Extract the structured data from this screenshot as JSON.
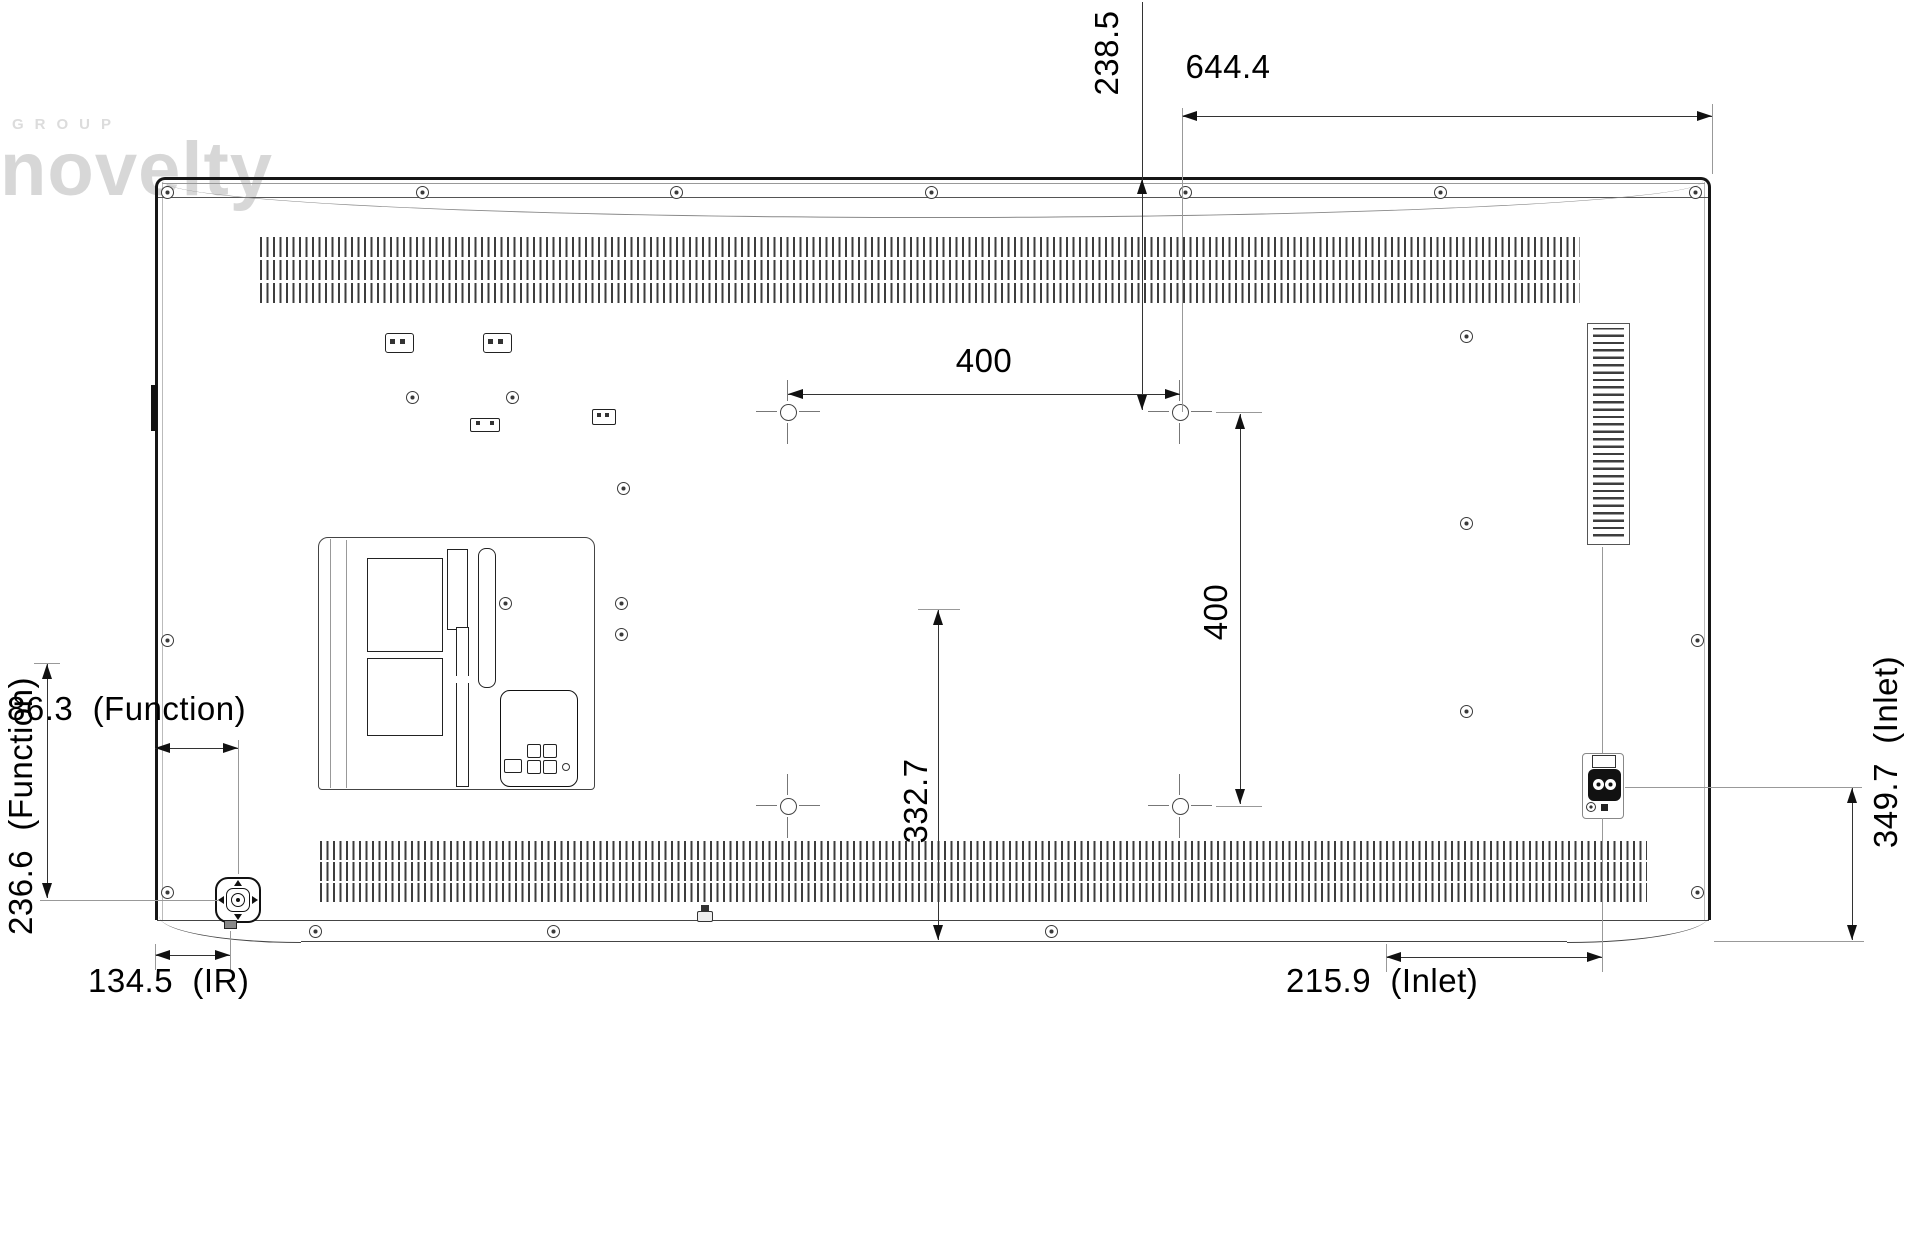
{
  "watermark": {
    "group": "GROUP",
    "name": "novelty"
  },
  "dimensions": {
    "vesa_top_offset": {
      "text": "238.5",
      "orientation": "vertical",
      "meaning": "top edge to upper VESA hole row"
    },
    "top_right_width": {
      "text": "644.4",
      "orientation": "horizontal",
      "meaning": "upper VESA hole to right edge"
    },
    "vesa_width": {
      "text": "400",
      "orientation": "horizontal",
      "meaning": "VESA hole horizontal pitch"
    },
    "vesa_height": {
      "text": "400",
      "orientation": "vertical",
      "meaning": "VESA hole vertical pitch"
    },
    "function_offset_x": {
      "text": "86.3  (Function)",
      "orientation": "horizontal",
      "meaning": "left edge to function button"
    },
    "function_offset_y": {
      "text": "236.6  (Function)",
      "orientation": "vertical",
      "meaning": "function button vertical offset"
    },
    "ir_offset": {
      "text": "134.5  (IR)",
      "orientation": "horizontal",
      "meaning": "left edge to IR sensor"
    },
    "bottom_center": {
      "text": "332.7",
      "orientation": "vertical",
      "meaning": "VESA center to bottom edge"
    },
    "inlet_offset_x": {
      "text": "215.9  (Inlet)",
      "orientation": "horizontal",
      "meaning": "AC inlet horizontal offset"
    },
    "inlet_offset_y": {
      "text": "349.7  (Inlet)",
      "orientation": "vertical",
      "meaning": "AC inlet height from bottom"
    }
  }
}
